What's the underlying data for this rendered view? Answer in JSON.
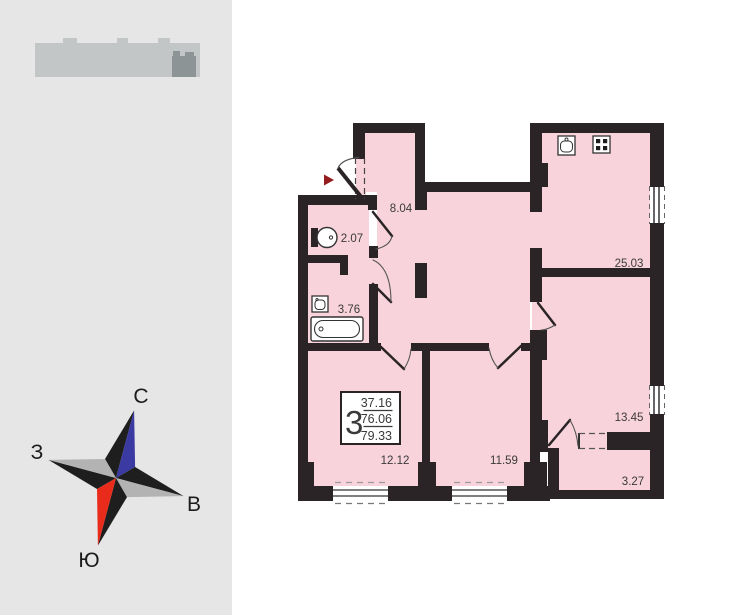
{
  "palette": {
    "sidebar_bg": "#e6e6e6",
    "wall": "#2b2426",
    "room_fill": "#f8d3dc",
    "entry_marker": "#941c1f",
    "building_body": "#c3c6c6",
    "building_highlight": "#8d9496",
    "compass_blue": "#3a3aa2",
    "compass_red": "#e92b1c",
    "compass_gray": "#b3b3b3",
    "compass_dark": "#1e1e1e"
  },
  "compass": {
    "north": "С",
    "west": "З",
    "east": "В",
    "south": "Ю"
  },
  "apartment": {
    "rooms_count": "3",
    "area_living": "37.16",
    "area_main": "76.06",
    "area_total": "79.33"
  },
  "room_areas": {
    "hall": "8.04",
    "wc": "2.07",
    "bath": "3.76",
    "kitchen_living": "25.03",
    "room_a": "12.12",
    "room_b": "11.59",
    "room_c": "13.45",
    "balcony": "3.27"
  }
}
